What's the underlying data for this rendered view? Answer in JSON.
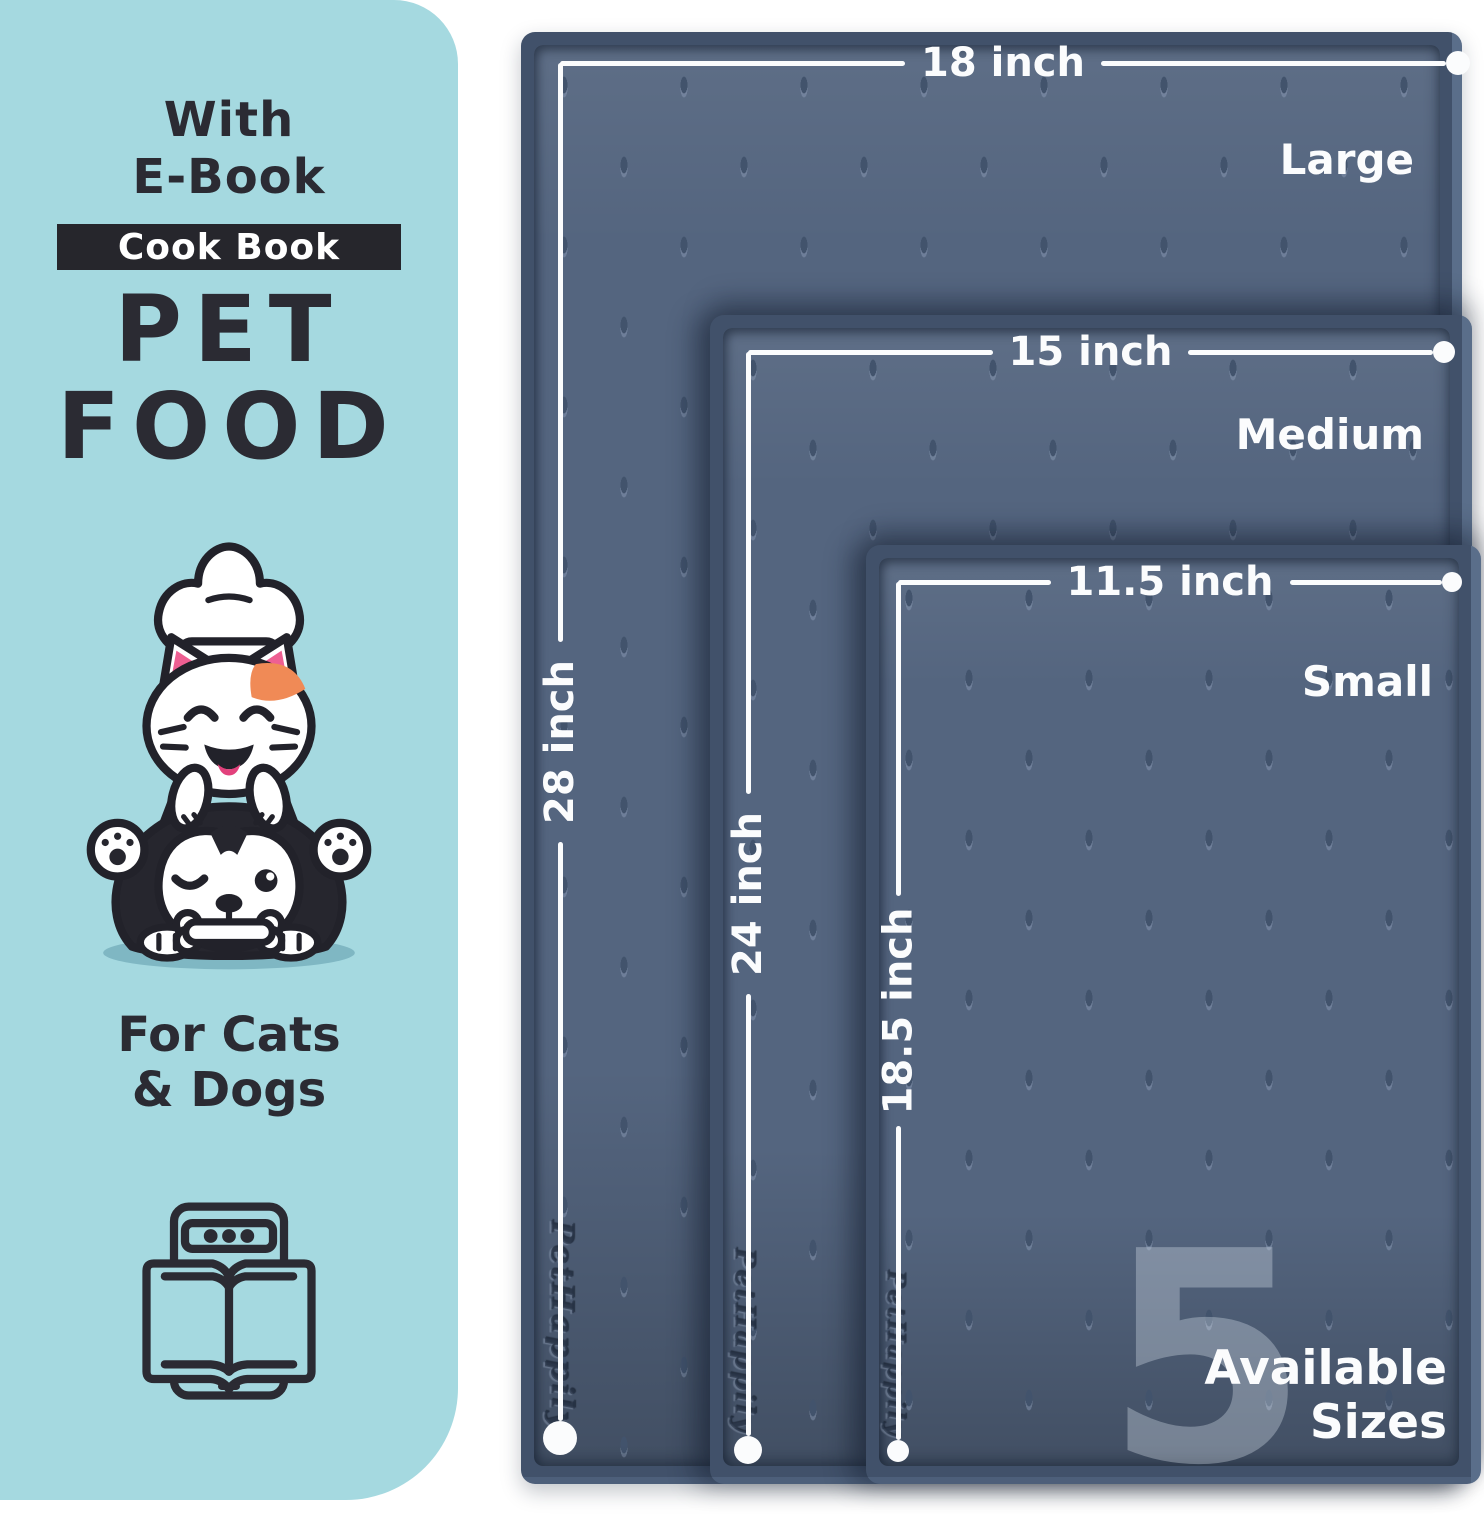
{
  "colors": {
    "panel_bg": "#a5d9e0",
    "ink": "#2b2b33",
    "badge_bg": "#26262c",
    "mat_rim": "#41516a",
    "mat_surface": "#54657f",
    "annotation_white": "#fbfcfd",
    "ear_pink": "#ee5f92",
    "patch_orange": "#f08a56"
  },
  "panel": {
    "headline_line1": "With",
    "headline_line2": "E-Book",
    "badge": "Cook Book",
    "title_line1": "PET",
    "title_line2": "FOOD",
    "audience_line1": "For Cats",
    "audience_line2": "& Dogs"
  },
  "mats": [
    {
      "name": "Large",
      "width_label": "18 inch",
      "height_label": "28 inch",
      "brand": "PetHappily"
    },
    {
      "name": "Medium",
      "width_label": "15 inch",
      "height_label": "24 inch",
      "brand": "PetHappily"
    },
    {
      "name": "Small",
      "width_label": "11.5 inch",
      "height_label": "18.5 inch",
      "brand": "PetHappily"
    }
  ],
  "availability": {
    "count": "5",
    "line1": "Available",
    "line2": "Sizes"
  }
}
